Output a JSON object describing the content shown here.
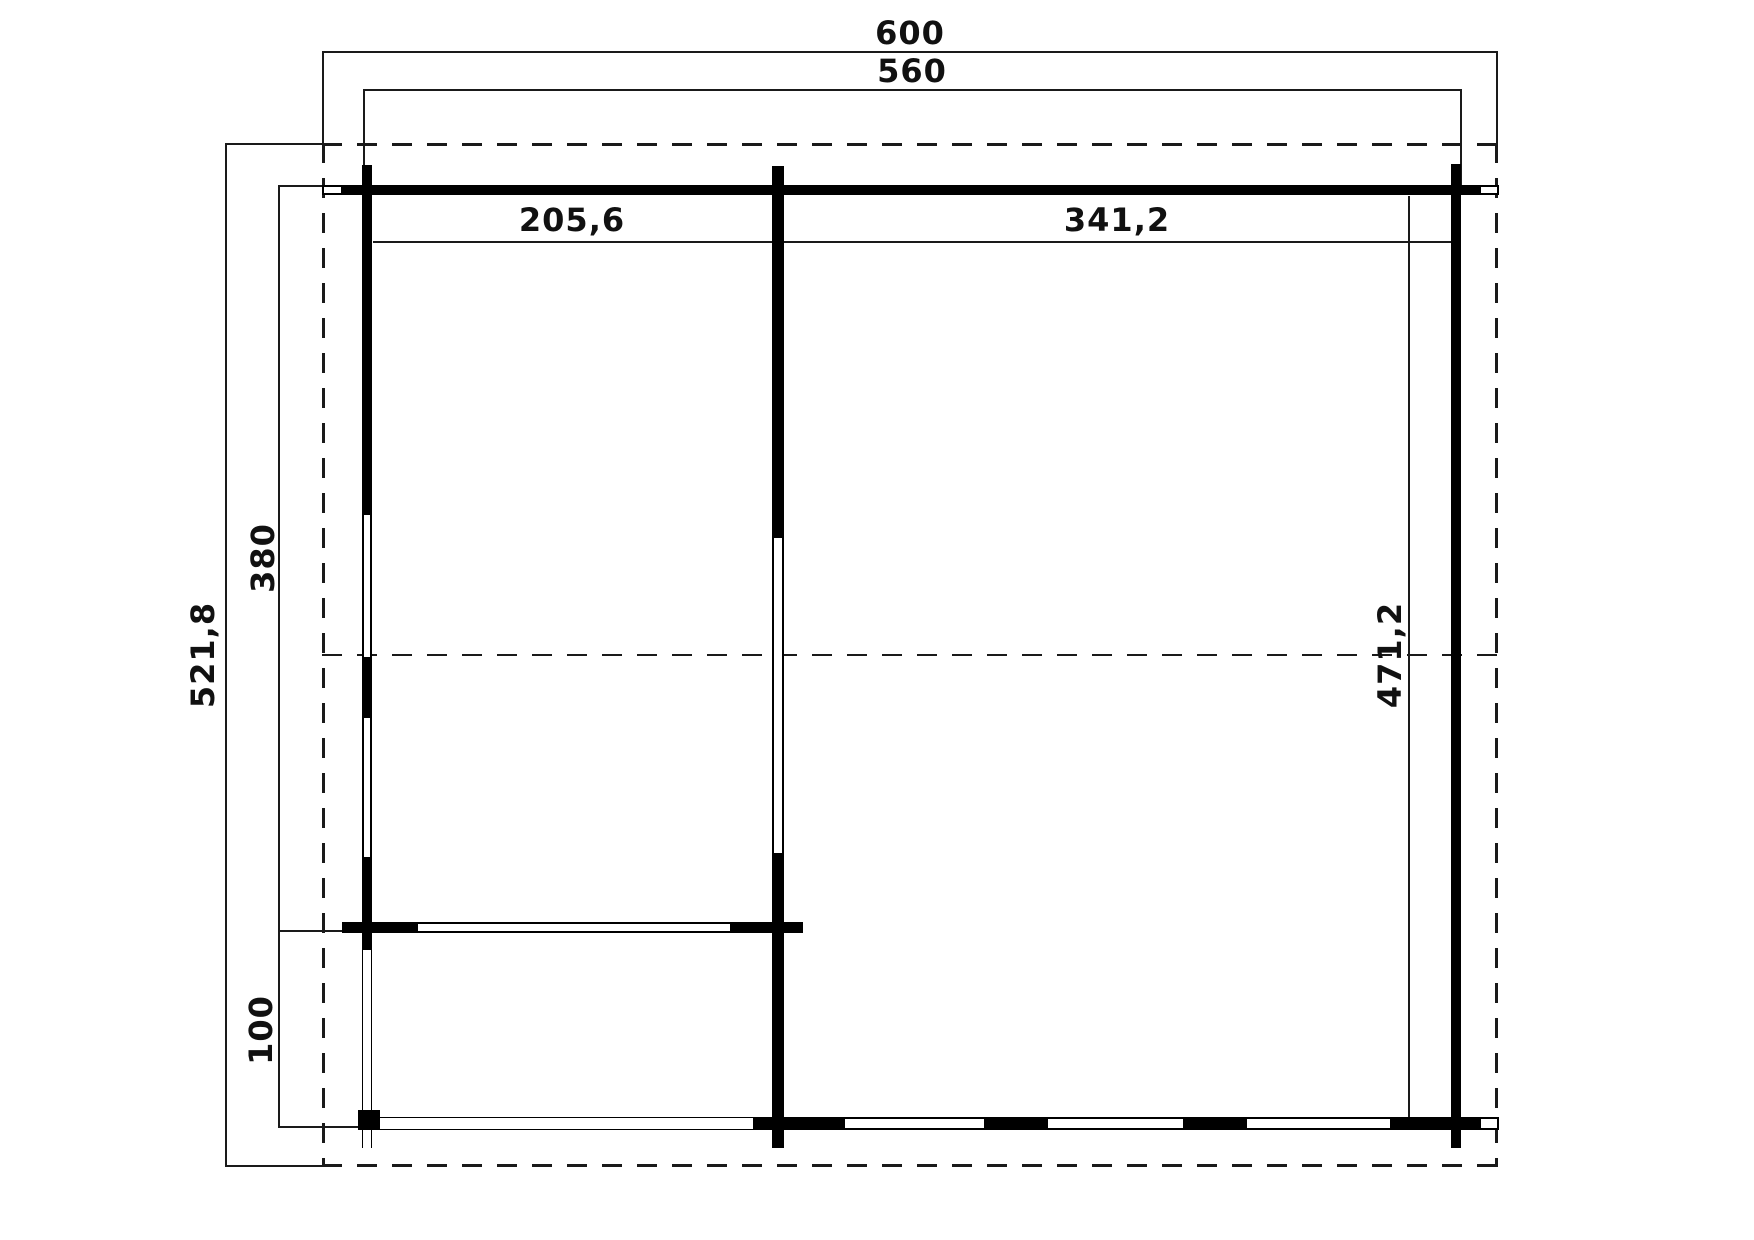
{
  "drawing": {
    "type": "floor-plan",
    "colors": {
      "wall": "#000000",
      "line": "#1a1a1a",
      "background": "#ffffff"
    },
    "labels": {
      "overall_width": "600",
      "building_width": "560",
      "left_room_width": "205,6",
      "right_room_width": "341,2",
      "overall_depth": "521,8",
      "main_depth": "380",
      "annex_depth": "100",
      "right_room_depth": "471,2"
    }
  }
}
